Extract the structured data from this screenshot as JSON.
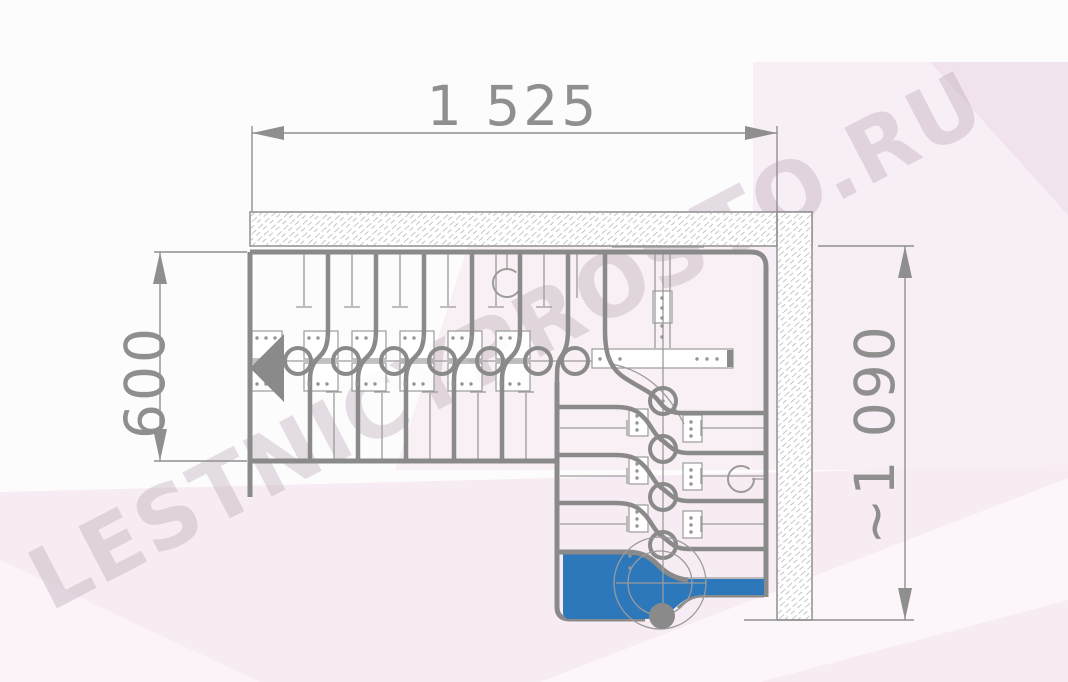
{
  "watermark": {
    "text": "LESTNICYPROSTO.RU",
    "color": "rgba(184,168,181,0.38)"
  },
  "dimensions": {
    "width": {
      "label": "1 525"
    },
    "depth": {
      "label": "600"
    },
    "height": {
      "label": "~1 090"
    }
  },
  "palette": {
    "step_blue": "#2d77bb",
    "line_gray": "#8a8a8a",
    "thin_gray": "#9b9b9b",
    "dim_gray": "#8f8f8f",
    "background_pink": "#f7ecf3"
  }
}
